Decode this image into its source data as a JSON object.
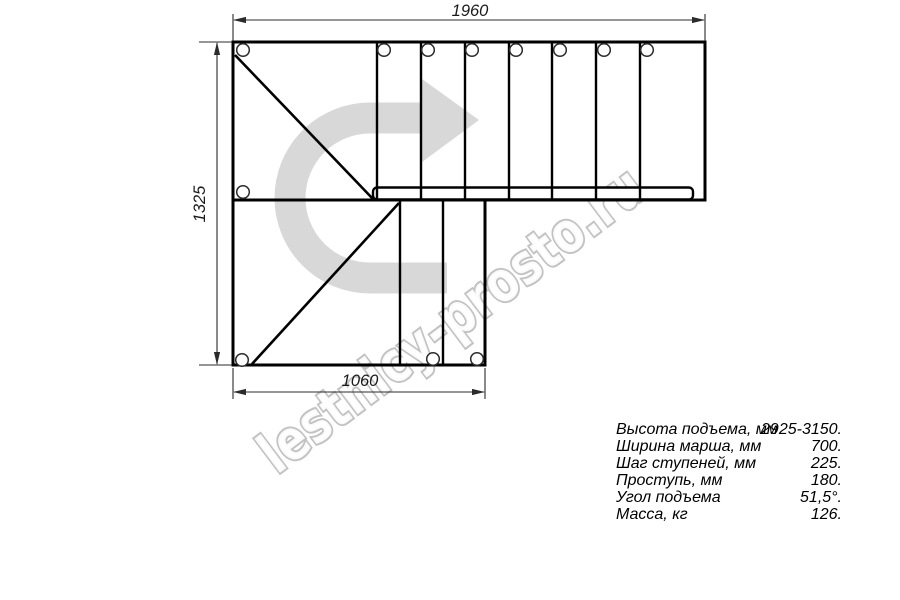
{
  "title": "Staircase plan drawing",
  "watermark": {
    "text": "lestnicy-prosto.ru",
    "arrow_icon": "u-turn-right-arrow",
    "arrow_color": "#d8d8d8",
    "text_outline_color": "#c2c2c2"
  },
  "dimensions": {
    "top": "1960",
    "left": "1325",
    "bottom": "1060"
  },
  "specs": {
    "rows": [
      {
        "label": "Высота подъема, мм",
        "value": "2925-3150."
      },
      {
        "label": "Ширина марша, мм",
        "value": "700."
      },
      {
        "label": "Шаг ступеней, мм",
        "value": "225."
      },
      {
        "label": "Проступь, мм",
        "value": "180."
      },
      {
        "label": "Угол подъема",
        "value": "51,5°."
      },
      {
        "label": "Масса, кг",
        "value": "126."
      }
    ]
  },
  "colors": {
    "drawing_line": "#000000",
    "dimension_line": "#2b2b2b",
    "background": "#ffffff"
  }
}
